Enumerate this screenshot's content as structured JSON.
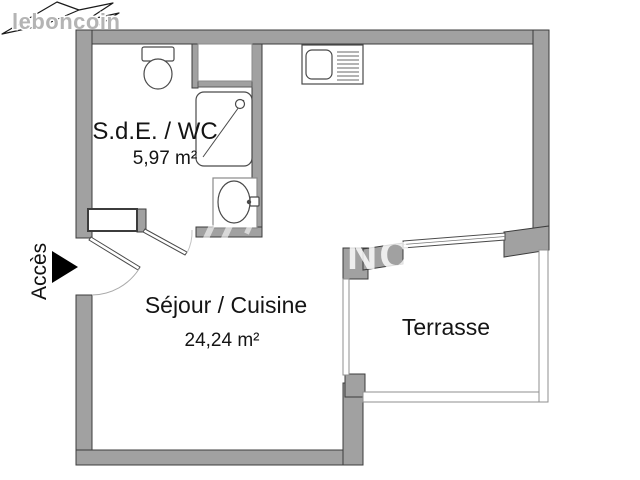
{
  "brand": {
    "logo_text": "leboncoin"
  },
  "watermark": {
    "text": "NC"
  },
  "access": {
    "label": "Accès"
  },
  "rooms": [
    {
      "id": "sde-wc",
      "name": "S.d.E. / WC",
      "area": "5,97 m²"
    },
    {
      "id": "sejour-cuisine",
      "name": "Séjour / Cuisine",
      "area": "24,24 m²"
    },
    {
      "id": "terrasse",
      "name": "Terrasse"
    }
  ],
  "fixtures": [
    "toilet",
    "shower",
    "washbasin",
    "kitchen-sink",
    "closet-niche",
    "window-box"
  ],
  "features": [
    "entrance-door",
    "bathroom-door",
    "sliding-bay-window",
    "terrace-railing"
  ],
  "colors": {
    "wall": "#a1a1a1",
    "wall_outline": "#3c3c3c",
    "railing": "#8f8f8f",
    "text": "#141414",
    "logo_gray": "#b4b4b4",
    "background": "#ffffff"
  }
}
